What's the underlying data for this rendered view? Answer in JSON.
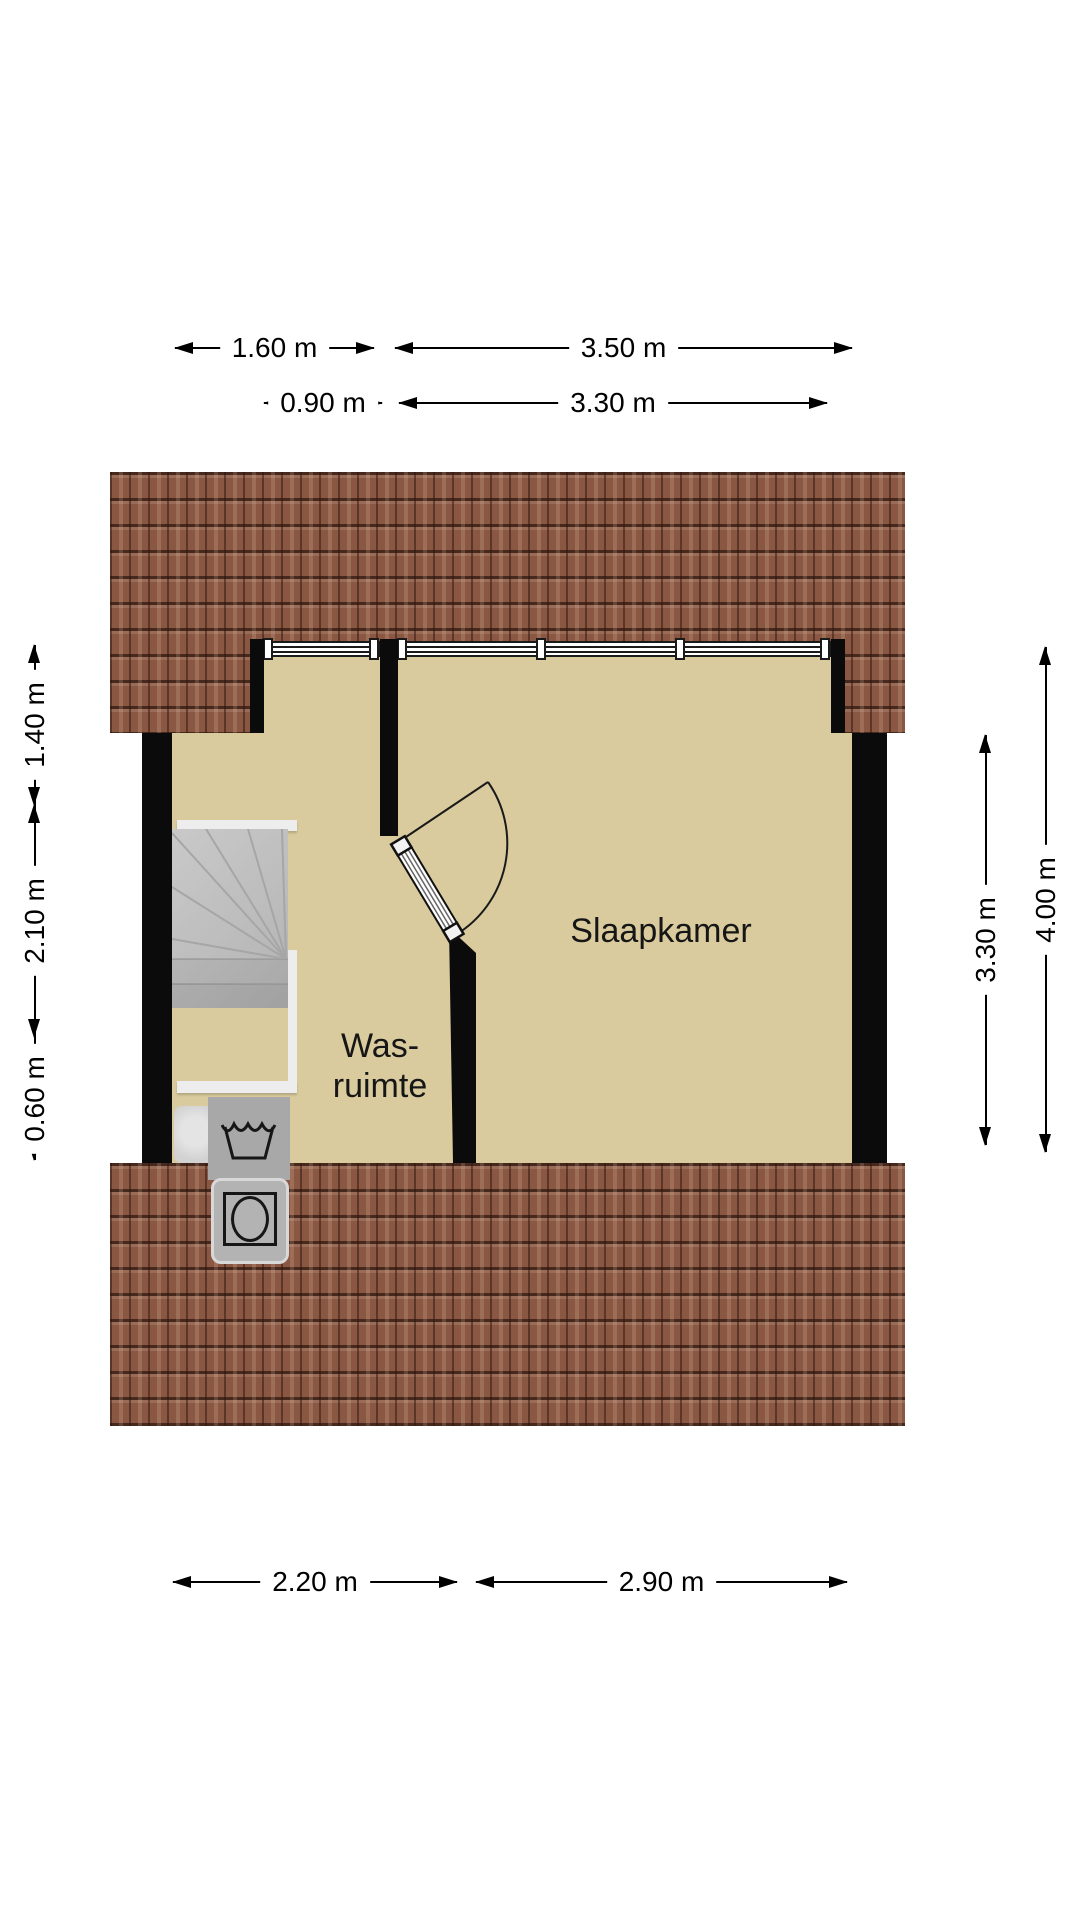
{
  "page": {
    "type": "floor-plan",
    "background": "#ffffff"
  },
  "colors": {
    "roof": "#8a5743",
    "floor": "#d9cb9d",
    "wall": "#0b0b0b",
    "stairs": "#bfbfbf",
    "appliance": "#a8a8a8",
    "dimtext": "#000000"
  },
  "rooms": [
    {
      "label": "Slaapkamer"
    },
    {
      "label": "Was-ruimte",
      "label_line_1": "Was-",
      "label_line_2": "ruimte"
    }
  ],
  "fixtures": [
    {
      "name": "stairs"
    },
    {
      "name": "door"
    },
    {
      "name": "windows"
    },
    {
      "name": "washing-machine"
    },
    {
      "name": "sink"
    }
  ],
  "dimensions": {
    "top_row_1": [
      {
        "label": "1.60 m"
      },
      {
        "label": "3.50 m"
      }
    ],
    "top_row_2": [
      {
        "label": "0.90 m"
      },
      {
        "label": "3.30 m"
      }
    ],
    "left": [
      {
        "label": "1.40 m"
      },
      {
        "label": "2.10 m"
      },
      {
        "label": "0.60 m"
      }
    ],
    "right": [
      {
        "label": "3.30 m"
      },
      {
        "label": "4.00 m"
      }
    ],
    "bottom": [
      {
        "label": "2.20 m"
      },
      {
        "label": "2.90 m"
      }
    ]
  }
}
